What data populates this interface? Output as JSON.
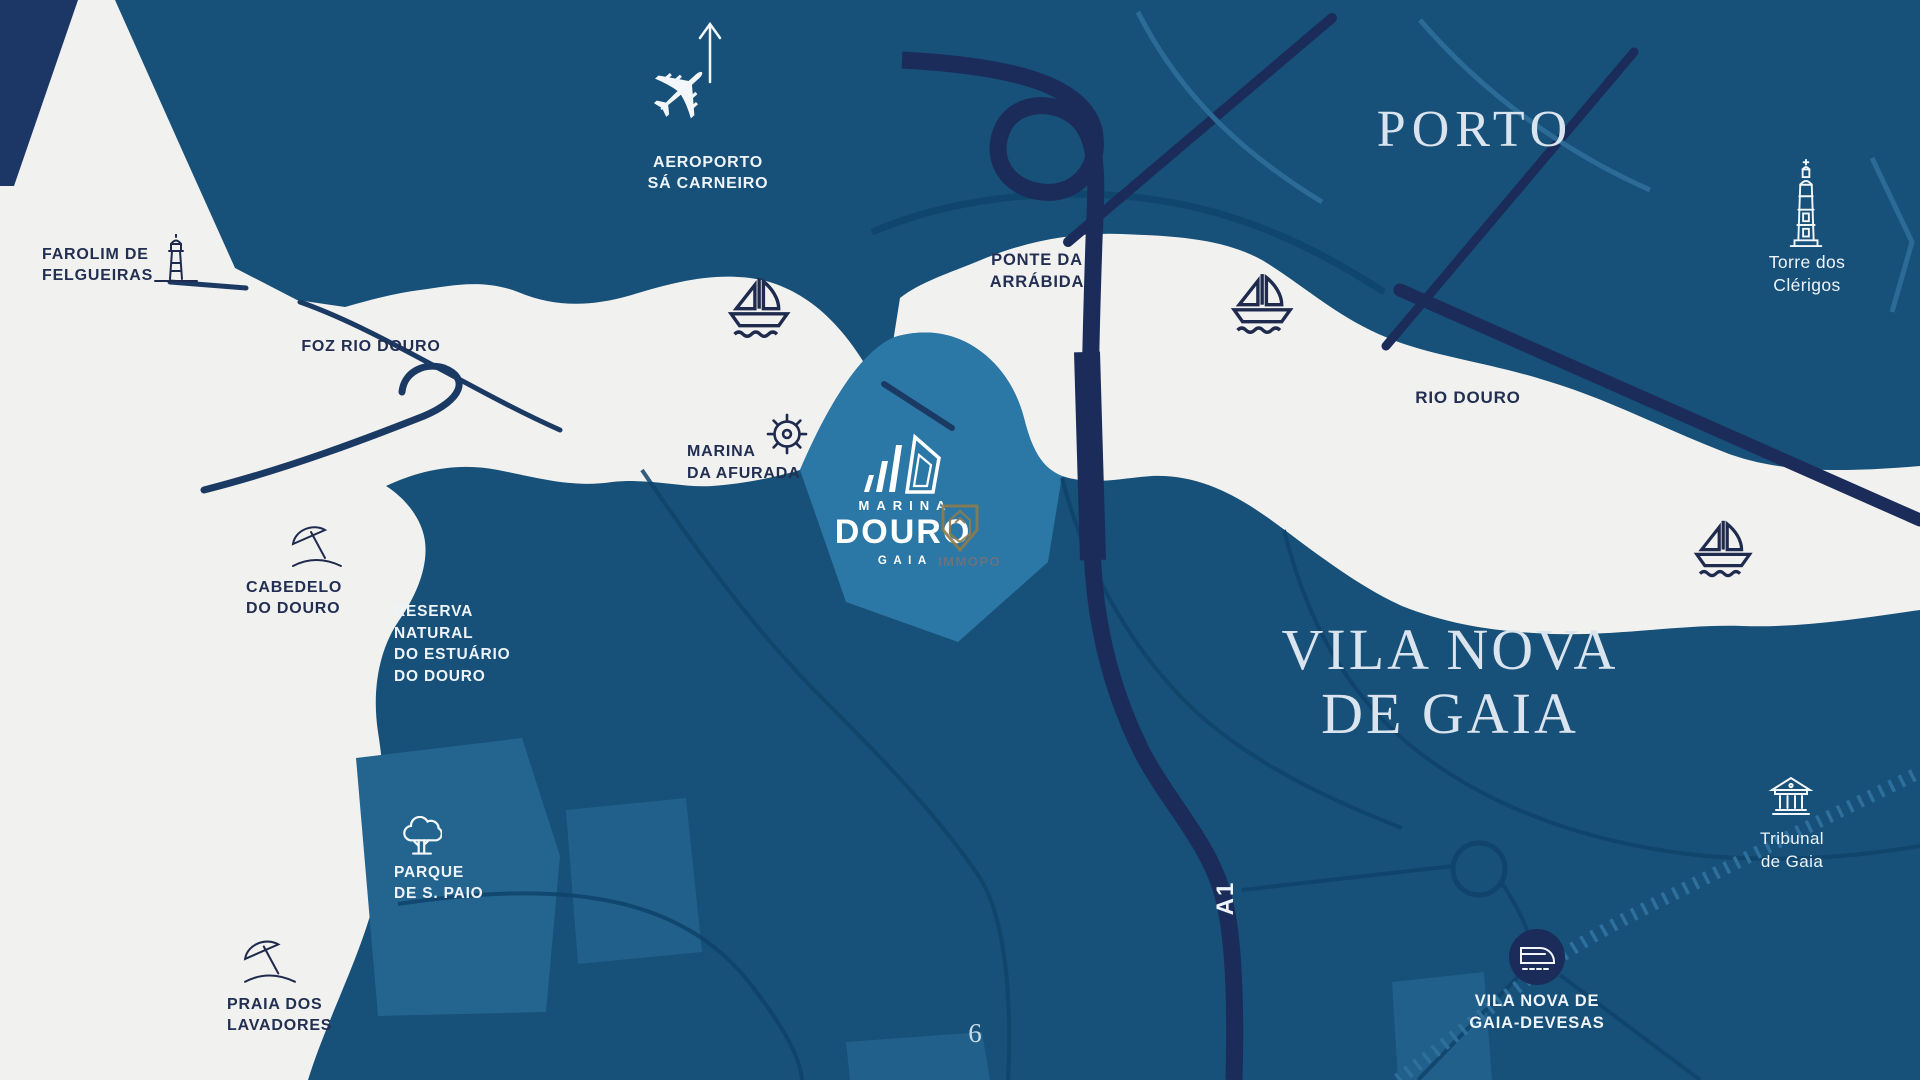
{
  "page_number": "6",
  "titles": {
    "porto": "PORTO",
    "gaia": "VILA NOVA\nDE GAIA"
  },
  "river_labels": {
    "foz": "FOZ RIO DOURO",
    "rio": "RIO DOURO"
  },
  "roads": {
    "a1": "A1"
  },
  "landmarks": {
    "farolim": {
      "label": "FAROLIM DE\nFELGUEIRAS",
      "icon": "lighthouse-icon"
    },
    "aeroporto": {
      "label": "AEROPORTO\nSÁ CARNEIRO",
      "icon": "airplane-icon"
    },
    "ponte_arrabida": {
      "label": "PONTE DA\nARRÁBIDA"
    },
    "torre_clerigos": {
      "label": "Torre dos\nClérigos",
      "icon": "clerigos-tower-icon"
    },
    "marina_afurada": {
      "label": "MARINA\nDA AFURADA",
      "icon": "ship-wheel-icon"
    },
    "cabedelo": {
      "label": "CABEDELO\nDO DOURO",
      "icon": "beach-umbrella-icon"
    },
    "reserva": {
      "label": "RESERVA\nNATURAL\nDO ESTUÁRIO\nDO DOURO"
    },
    "parque_s_paio": {
      "label": "PARQUE\nDE S. PAIO",
      "icon": "tree-icon"
    },
    "praia_lavadores": {
      "label": "PRAIA DOS\nLAVADORES",
      "icon": "beach-umbrella-icon"
    },
    "tribunal": {
      "label": "Tribunal\nde Gaia",
      "icon": "courthouse-icon"
    },
    "devesas": {
      "label": "VILA NOVA DE\nGAIA-DEVESAS",
      "icon": "train-icon"
    }
  },
  "logo": {
    "top": "MARINA",
    "name": "DOURO",
    "sub": "GAIA",
    "partner": "IMMOPO"
  },
  "colors": {
    "water": "#f1f1ef",
    "land": "#175078",
    "zone_highlight": "#2b77a6",
    "park": "#24658f",
    "navy_road": "#1b2c5a",
    "rail": "#2e6f9c",
    "text_dark": "#222f52",
    "text_light": "#eef4fa",
    "title_serif": "#d9e4ee",
    "partner_gold": "#8d7c4e"
  }
}
